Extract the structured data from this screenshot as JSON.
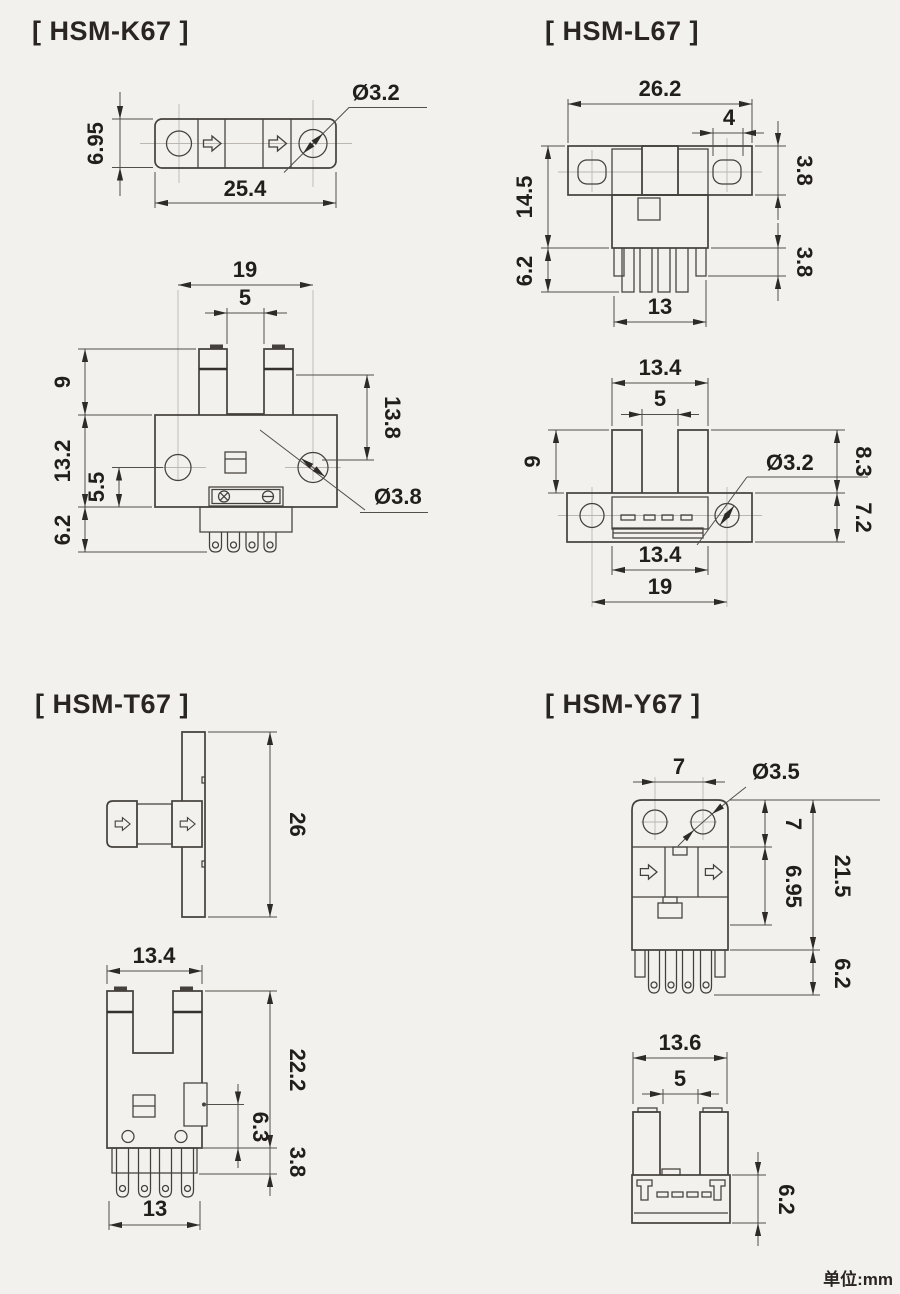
{
  "footer": {
    "unit": "单位:mm"
  },
  "palette": {
    "background": "#f2f1ee",
    "line": "#44403b",
    "dimension": "#524e48",
    "text": "#221e1a",
    "centerline": "#bcb8b1"
  },
  "models": {
    "k67": {
      "title": "[ HSM-K67 ]",
      "side": {
        "height": "6.95",
        "width": "25.4",
        "hole": "Ø3.2"
      },
      "front": {
        "pitch": "19",
        "slot": "5",
        "upper": "9",
        "body": "13.2",
        "lower": "5.5",
        "pins": "6.2",
        "depth": "13.8",
        "hole": "Ø3.8"
      }
    },
    "l67": {
      "title": "[ HSM-L67 ]",
      "front": {
        "width": "26.2",
        "hole_len": "4",
        "height": "14.5",
        "pins": "6.2",
        "bar": "3.8",
        "step": "3.8",
        "pin_row": "13"
      },
      "top": {
        "head": "13.4",
        "slot": "5",
        "prong": "9",
        "hole": "Ø3.2",
        "upper": "8.3",
        "base": "7.2",
        "body": "13.4",
        "pitch": "19"
      }
    },
    "t67": {
      "title": "[ HSM-T67 ]",
      "side": {
        "plate": "26"
      },
      "front": {
        "width": "13.4",
        "body": "22.2",
        "tab": "6.3",
        "step": "3.8",
        "pin_row": "13"
      }
    },
    "y67": {
      "title": "[ HSM-Y67 ]",
      "front": {
        "pitch": "7",
        "hole": "Ø3.5",
        "top": "7",
        "band": "6.95",
        "body": "21.5",
        "pins": "6.2"
      },
      "top": {
        "width": "13.6",
        "slot": "5",
        "base": "6.2"
      }
    }
  }
}
